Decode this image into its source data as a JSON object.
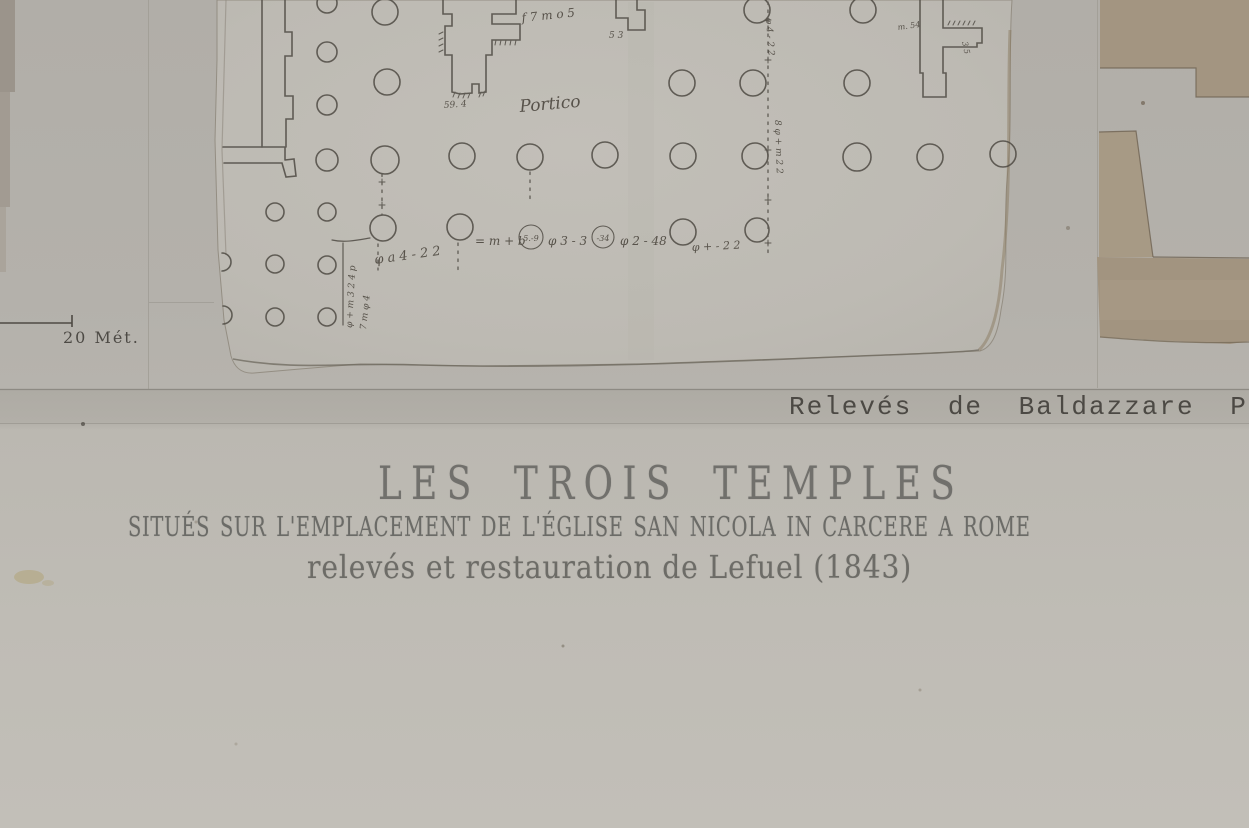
{
  "plate": {
    "title": "LES TROIS TEMPLES",
    "subtitle": "SITUÉS SUR L'EMPLACEMENT DE L'ÉGLISE SAN NICOLA IN CARCERE A ROME",
    "byline": "relevés et restauration de Lefuel (1843)",
    "credit": "Relevés de Baldazzare Per",
    "scale_label": "20 Mét."
  },
  "sketch": {
    "portico_label": "Portico",
    "top_note": "f 7 m o 5",
    "pier1_note": "59. 4",
    "pier3_note_a": "m. 54",
    "pier3_note_b": "3 5",
    "pier4_note": "5 3",
    "axis_note_upper": "φ 4 - 2 2",
    "axis_note_lower": "8 φ + m 2 2",
    "row_note_1": "= m + b",
    "row_circle_1": "5.-9",
    "row_note_2": "φ 3 - 3",
    "row_circle_2": "-34",
    "row_note_3": "φ 2 - 48",
    "row_note_4": "φ + - 2 2",
    "dim_note": "φ a 4 - 2 2",
    "bracket_note_1": "φ + m 3 2 4 p",
    "bracket_note_2": "7 m φ 4"
  },
  "colors": {
    "plate_paper": "#b4b1ab",
    "plate_paper_bottom": "#c2bfb8",
    "fragment_paper": "#bfbcb5",
    "ink": "#4f4b44",
    "handwriting": "#57524a",
    "sepia_wall": "#a39581",
    "torn_edge": "#8a7960",
    "title_text": "#71706c",
    "credit_text": "#4c4944",
    "rule_line": "#85827b"
  }
}
